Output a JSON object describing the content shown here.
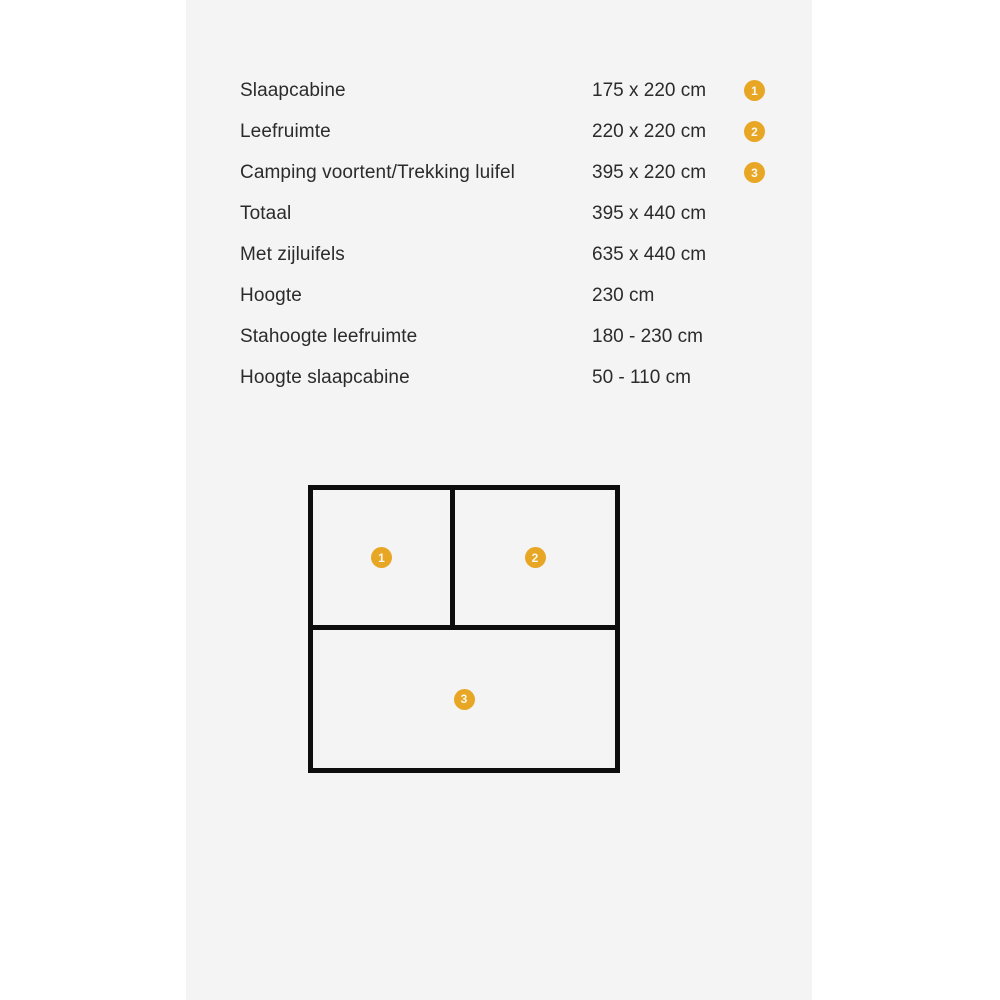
{
  "specs": {
    "rows": [
      {
        "label": "Slaapcabine",
        "value": "175 x 220 cm",
        "badge": "1"
      },
      {
        "label": "Leefruimte",
        "value": "220 x 220 cm",
        "badge": "2"
      },
      {
        "label": "Camping voortent/Trekking luifel",
        "value": "395 x 220 cm",
        "badge": "3"
      },
      {
        "label": "Totaal",
        "value": "395 x 440 cm"
      },
      {
        "label": "Met zijluifels",
        "value": "635 x 440 cm"
      },
      {
        "label": "Hoogte",
        "value": "230 cm"
      },
      {
        "label": "Stahoogte leefruimte",
        "value": "180 - 230 cm"
      },
      {
        "label": "Hoogte slaapcabine",
        "value": "50 - 110 cm"
      }
    ]
  },
  "diagram": {
    "cells": [
      {
        "badge": "1"
      },
      {
        "badge": "2"
      },
      {
        "badge": "3"
      }
    ]
  },
  "colors": {
    "badge_background": "#E8A625",
    "badge_text": "#FCF8EE",
    "panel_background": "#F5F4F4",
    "text": "#2B2B2B",
    "diagram_line": "#0D0D0D"
  }
}
